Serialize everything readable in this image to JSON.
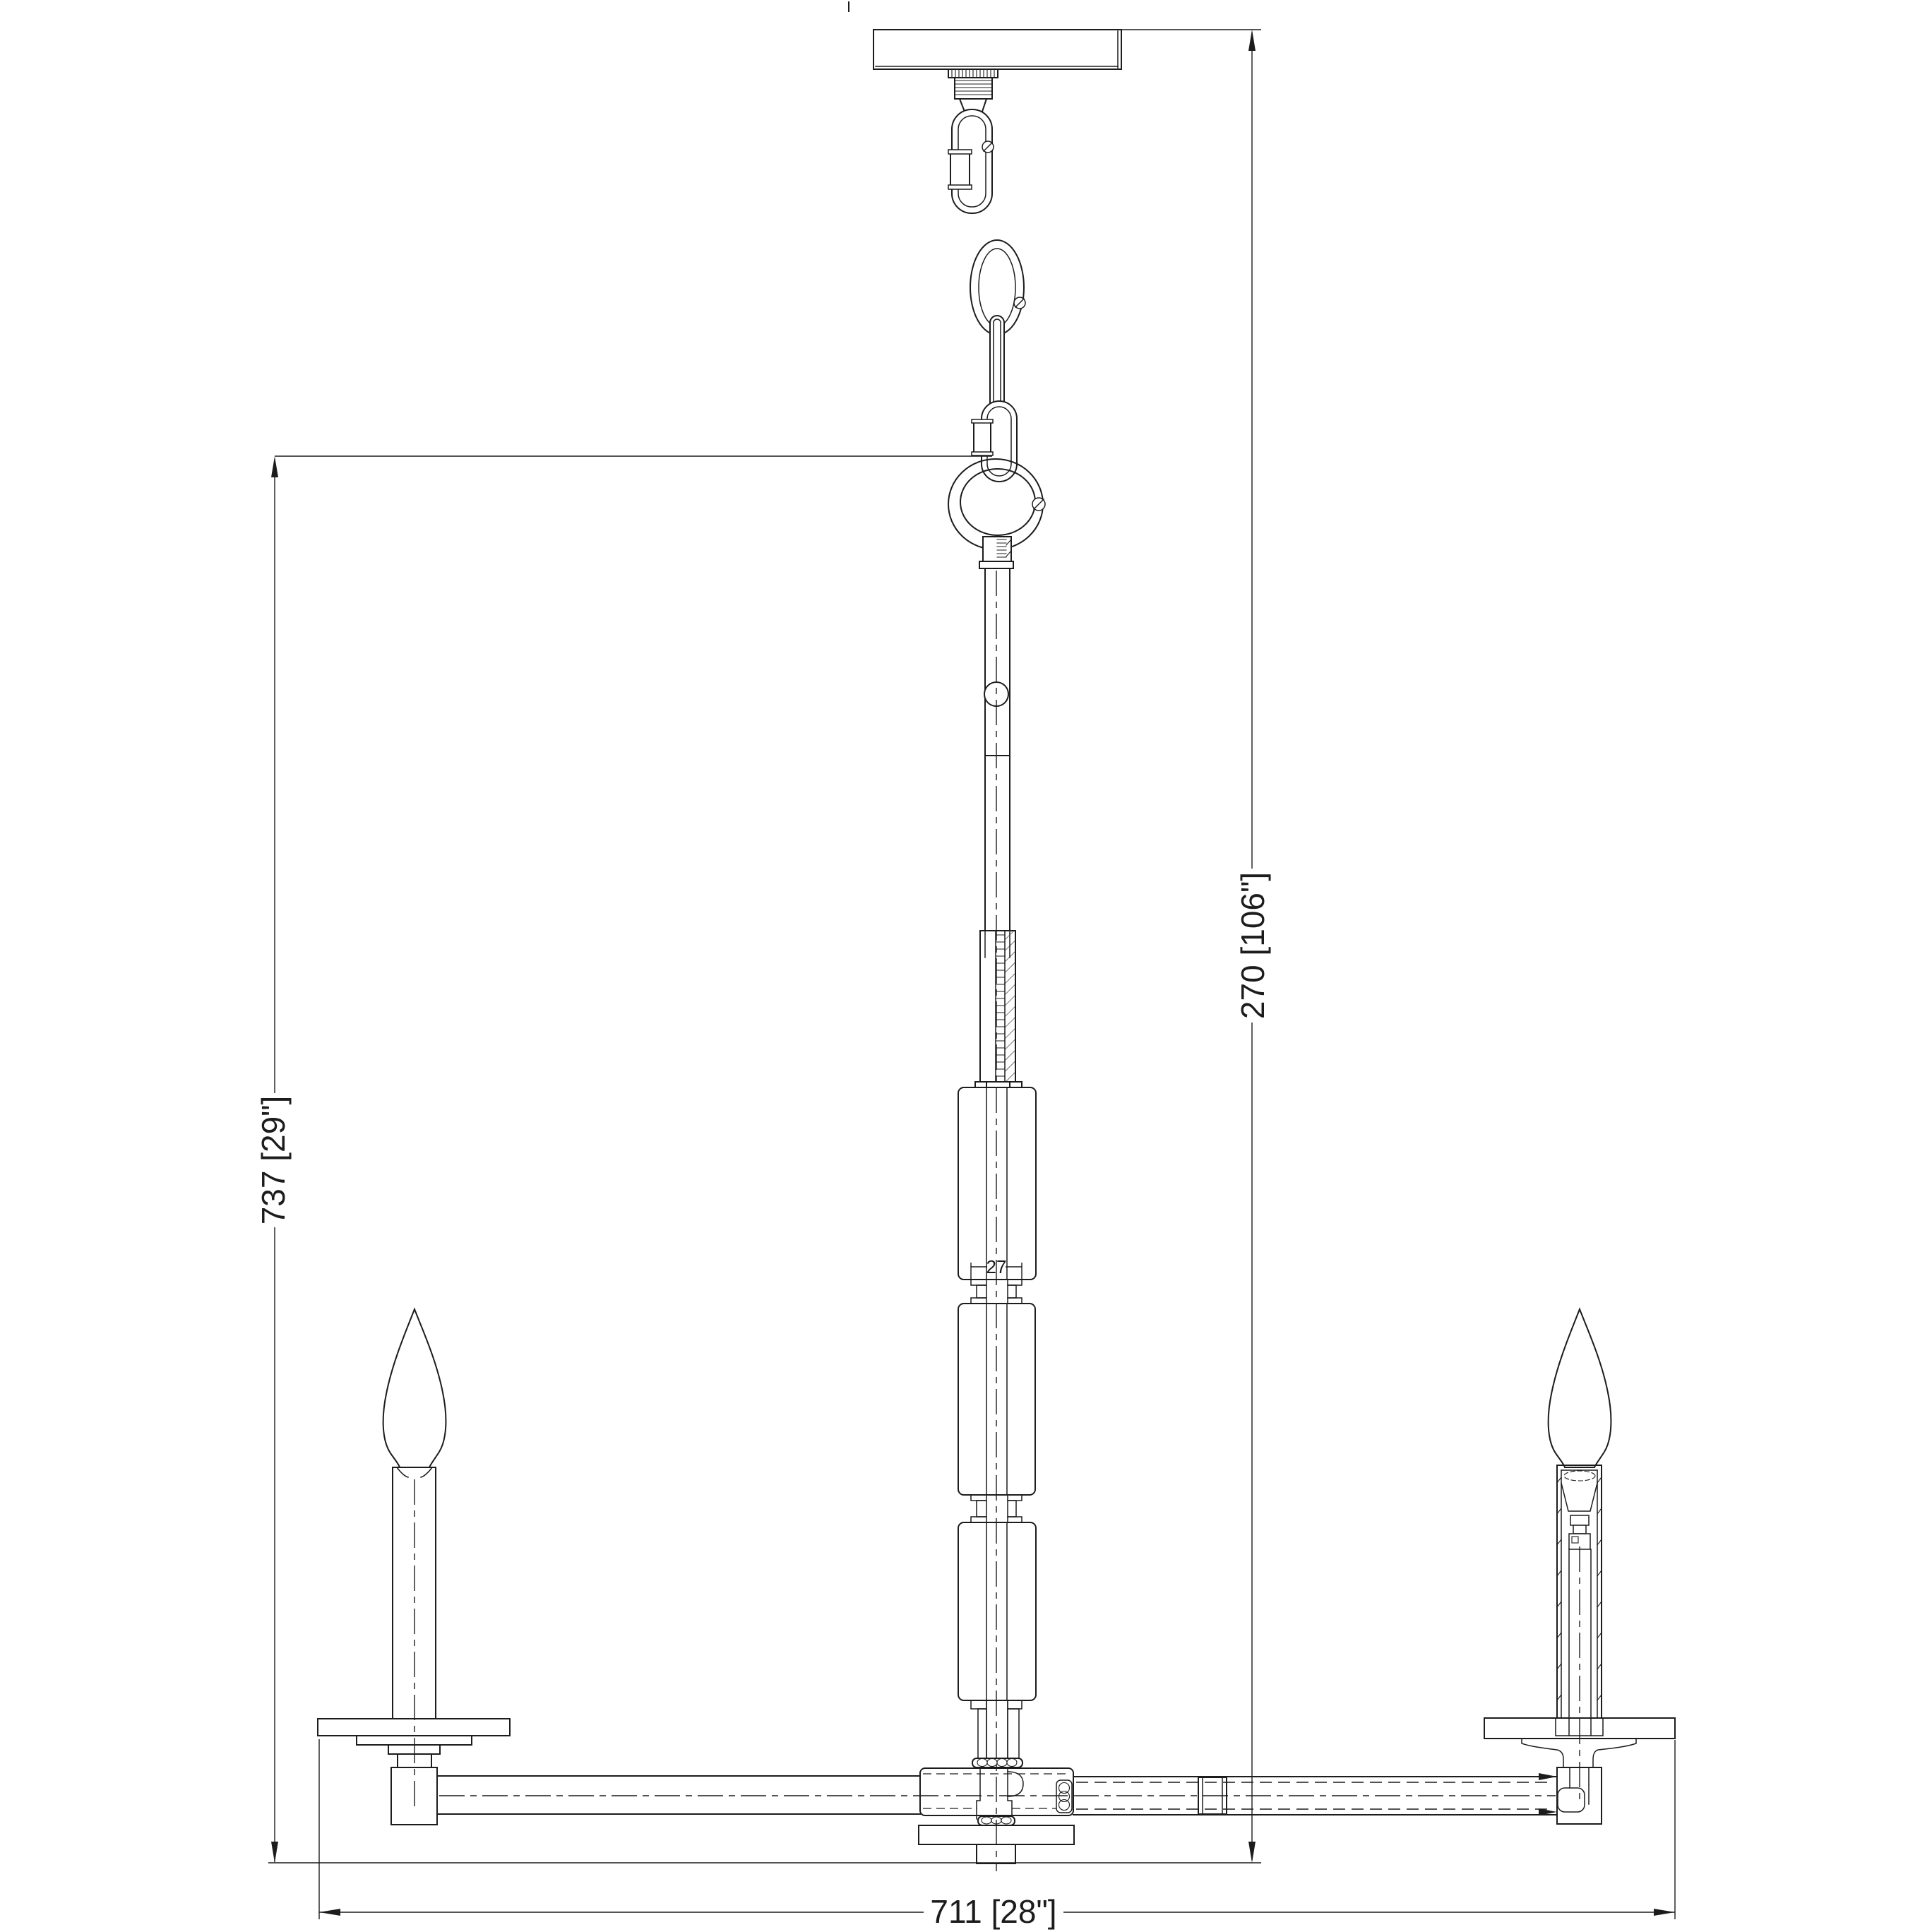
{
  "drawing": {
    "background": "#ffffff",
    "line_color": "#1c1c1c",
    "dimensions": {
      "fixture_height": "737 [29\"]",
      "overall_height": "270 [106\"]",
      "overall_width": "711 [28\"]",
      "column_bore": "27"
    }
  }
}
